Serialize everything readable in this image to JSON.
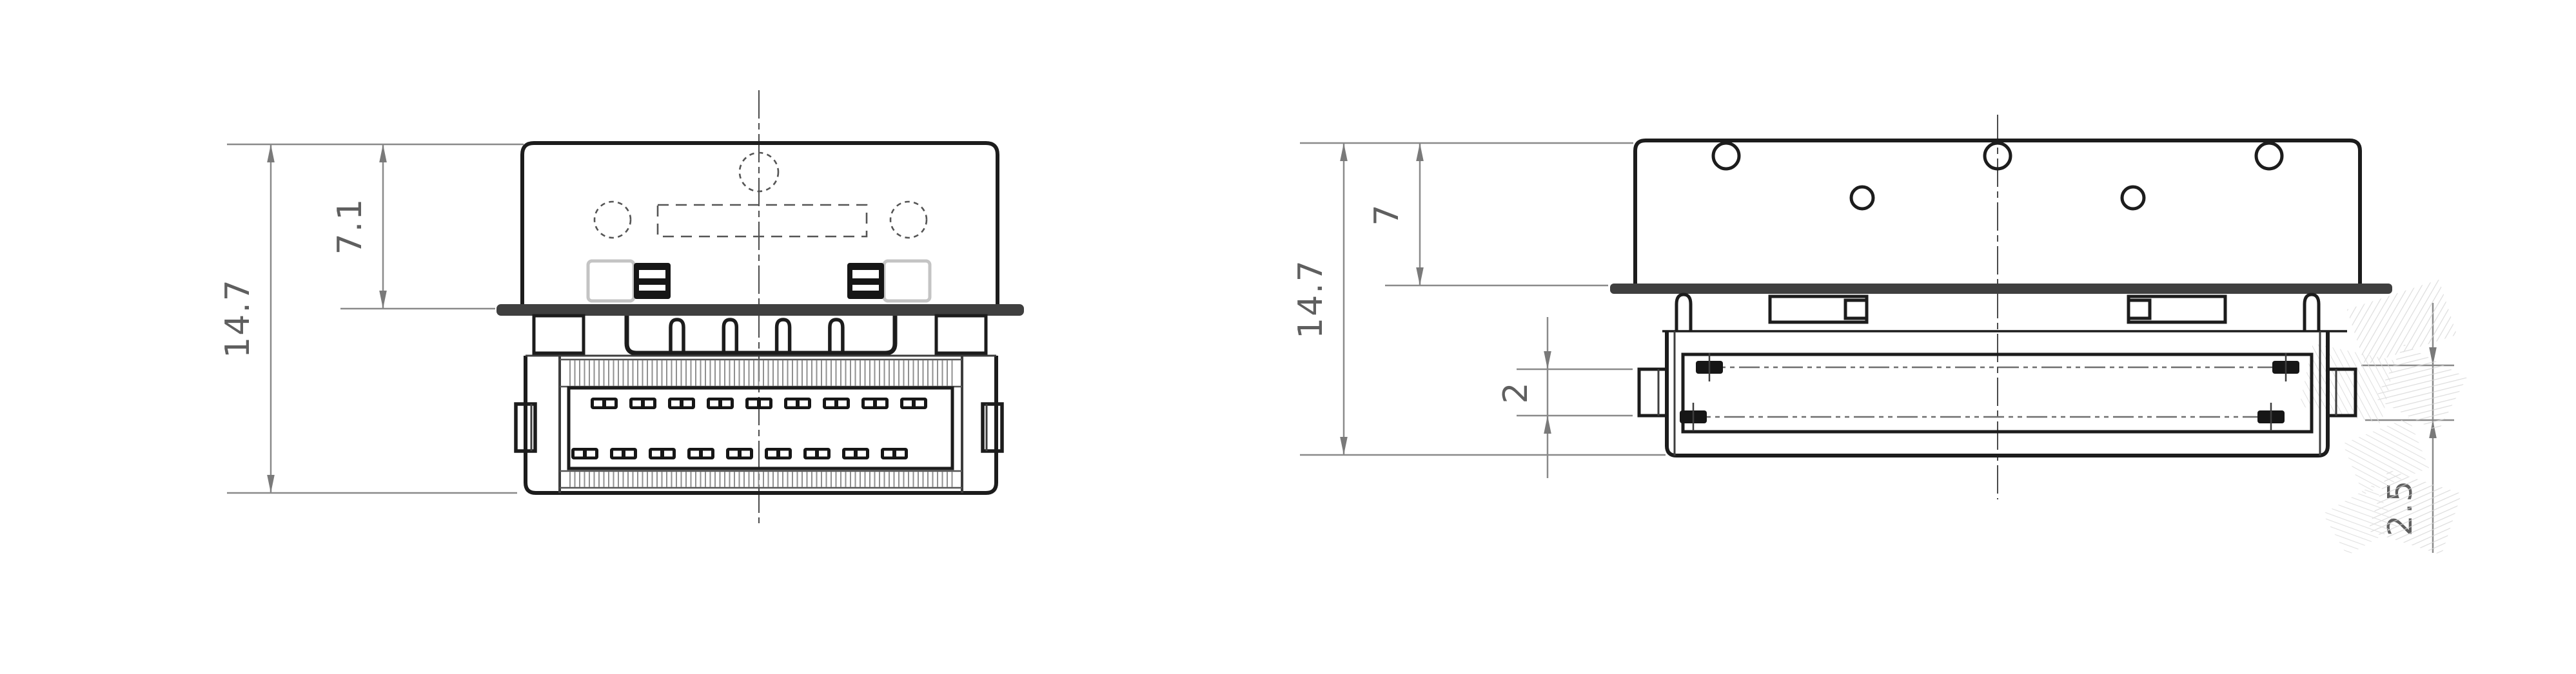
{
  "drawing": {
    "description": "Engineering drawing of a board connector: front view (left) and bottom view (right)",
    "colors": {
      "background": "#ffffff",
      "object_line": "#1c1c1c",
      "flange_fill": "#3f3f3f",
      "dimension_line": "#8a8a8a",
      "dimension_text": "#5f5f5f",
      "hatch_line": "#8f8f8f",
      "watermark": "#d7d7d7"
    },
    "front_view": {
      "name": "front-view",
      "dim_overall_height": {
        "label": "14.7"
      },
      "dim_upper_height": {
        "label": "7.1"
      },
      "top_pad_count": 9,
      "bottom_pad_count": 9,
      "pin_notch_count": 4,
      "dashed_circle_count": 3
    },
    "bottom_view": {
      "name": "bottom-view",
      "dim_overall_height": {
        "label": "14.7"
      },
      "dim_upper_height": {
        "label": "7"
      },
      "dim_side_tab": {
        "label": "2"
      },
      "dim_contact_edge": {
        "label": "2.5"
      },
      "hole_count_top_row": 3,
      "hole_count_second_row": 2
    }
  }
}
